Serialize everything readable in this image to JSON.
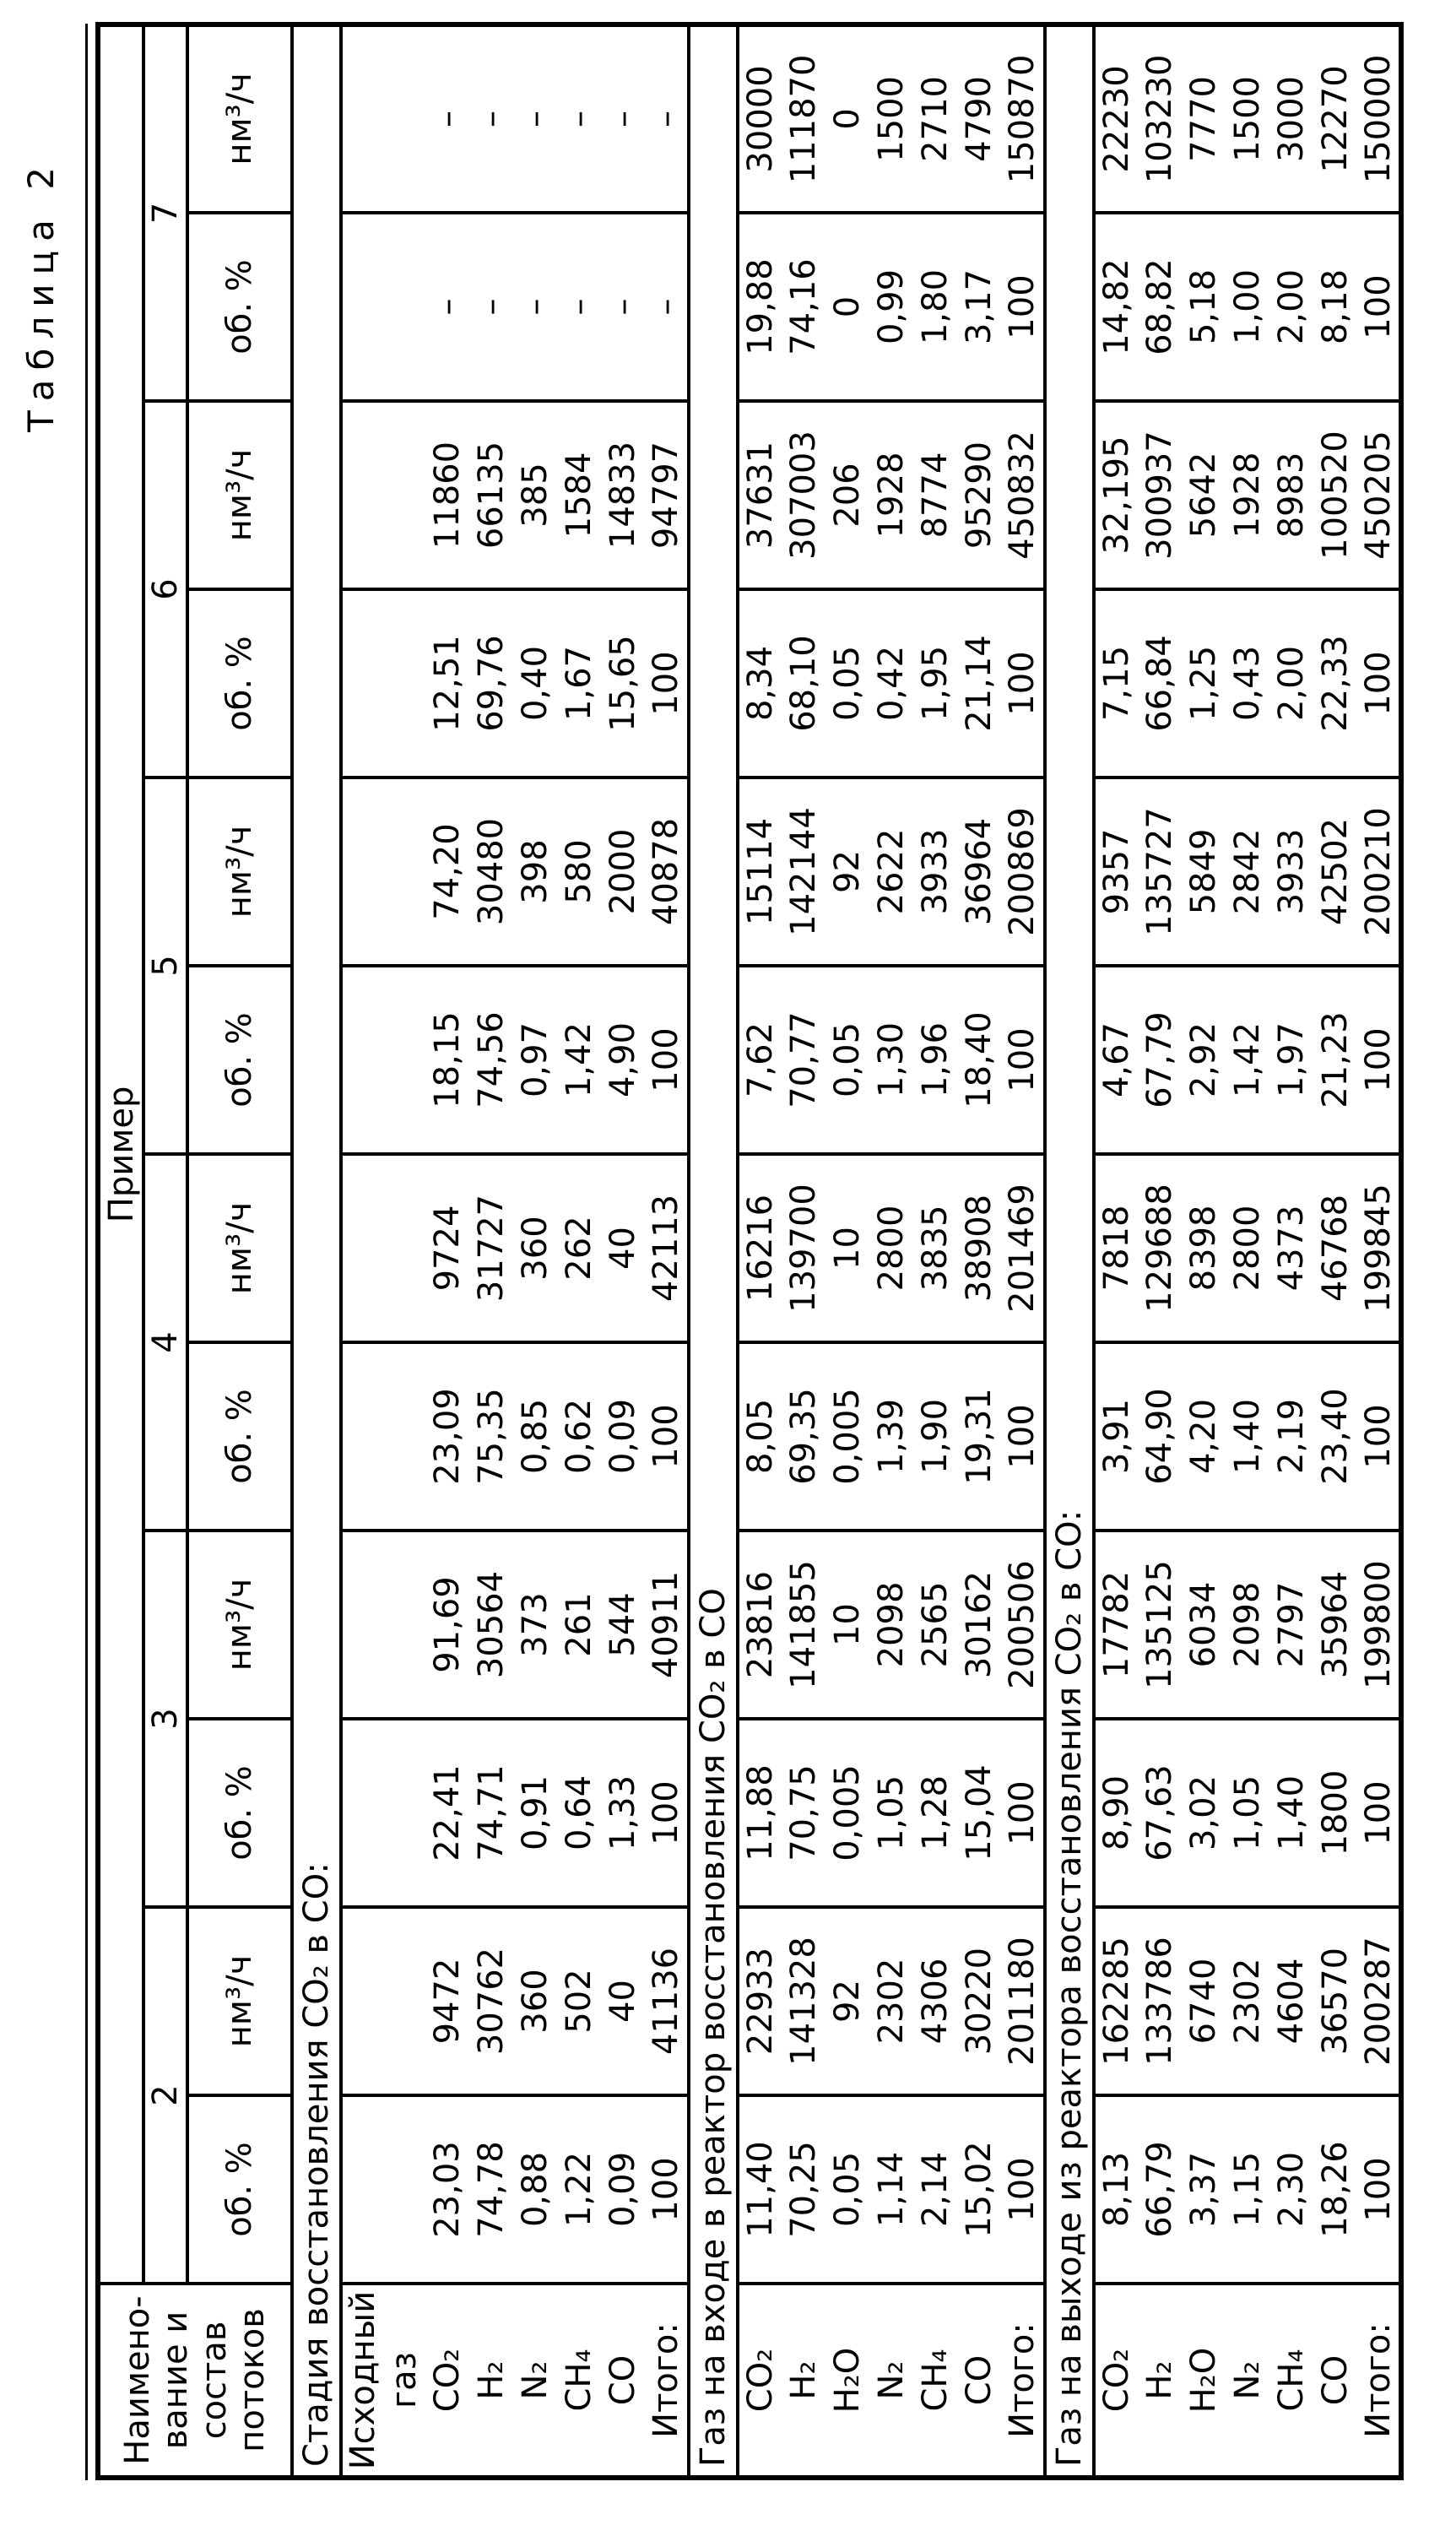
{
  "caption": "Таблица 2",
  "table": {
    "header": {
      "name_lines": [
        "Наимено-",
        "вание и",
        "состав",
        "потоков"
      ],
      "group_title": "Пример",
      "columns": [
        "2",
        "3",
        "4",
        "5",
        "6",
        "7"
      ],
      "units": [
        "об. %",
        "нм³/ч"
      ]
    },
    "sections": [
      {
        "title": "Стадия восстановления CO₂ в CO:",
        "pre_rows": [
          "Исходный",
          "газ"
        ],
        "rows": [
          {
            "label": "CO₂",
            "values": [
              "23,03",
              "9472",
              "22,41",
              "91,69",
              "23,09",
              "9724",
              "18,15",
              "74,20",
              "12,51",
              "11860",
              "–",
              "–"
            ]
          },
          {
            "label": "H₂",
            "values": [
              "74,78",
              "30762",
              "74,71",
              "30564",
              "75,35",
              "31727",
              "74,56",
              "30480",
              "69,76",
              "66135",
              "–",
              "–"
            ]
          },
          {
            "label": "N₂",
            "values": [
              "0,88",
              "360",
              "0,91",
              "373",
              "0,85",
              "360",
              "0,97",
              "398",
              "0,40",
              "385",
              "–",
              "–"
            ]
          },
          {
            "label": "CH₄",
            "values": [
              "1,22",
              "502",
              "0,64",
              "261",
              "0,62",
              "262",
              "1,42",
              "580",
              "1,67",
              "1584",
              "–",
              "–"
            ]
          },
          {
            "label": "CO",
            "values": [
              "0,09",
              "40",
              "1,33",
              "544",
              "0,09",
              "40",
              "4,90",
              "2000",
              "15,65",
              "14833",
              "–",
              "–"
            ]
          },
          {
            "label": "Итого:",
            "values": [
              "100",
              "41136",
              "100",
              "40911",
              "100",
              "42113",
              "100",
              "40878",
              "100",
              "94797",
              "–",
              "–"
            ]
          }
        ]
      },
      {
        "title": "Газ на входе в реактор восстановления CO₂ в CO",
        "pre_rows": [],
        "rows": [
          {
            "label": "CO₂",
            "values": [
              "11,40",
              "22933",
              "11,88",
              "23816",
              "8,05",
              "16216",
              "7,62",
              "15114",
              "8,34",
              "37631",
              "19,88",
              "30000"
            ]
          },
          {
            "label": "H₂",
            "values": [
              "70,25",
              "141328",
              "70,75",
              "141855",
              "69,35",
              "139700",
              "70,77",
              "142144",
              "68,10",
              "307003",
              "74,16",
              "111870"
            ]
          },
          {
            "label": "H₂O",
            "values": [
              "0,05",
              "92",
              "0,005",
              "10",
              "0,005",
              "10",
              "0,05",
              "92",
              "0,05",
              "206",
              "0",
              "0"
            ]
          },
          {
            "label": "N₂",
            "values": [
              "1,14",
              "2302",
              "1,05",
              "2098",
              "1,39",
              "2800",
              "1,30",
              "2622",
              "0,42",
              "1928",
              "0,99",
              "1500"
            ]
          },
          {
            "label": "CH₄",
            "values": [
              "2,14",
              "4306",
              "1,28",
              "2565",
              "1,90",
              "3835",
              "1,96",
              "3933",
              "1,95",
              "8774",
              "1,80",
              "2710"
            ]
          },
          {
            "label": "CO",
            "values": [
              "15,02",
              "30220",
              "15,04",
              "30162",
              "19,31",
              "38908",
              "18,40",
              "36964",
              "21,14",
              "95290",
              "3,17",
              "4790"
            ]
          },
          {
            "label": "Итого:",
            "values": [
              "100",
              "201180",
              "100",
              "200506",
              "100",
              "201469",
              "100",
              "200869",
              "100",
              "450832",
              "100",
              "150870"
            ]
          }
        ]
      },
      {
        "title": "Газ на выходе из реактора восстановления CO₂ в CO:",
        "pre_rows": [],
        "rows": [
          {
            "label": "CO₂",
            "values": [
              "8,13",
              "162285",
              "8,90",
              "17782",
              "3,91",
              "7818",
              "4,67",
              "9357",
              "7,15",
              "32,195",
              "14,82",
              "22230"
            ]
          },
          {
            "label": "H₂",
            "values": [
              "66,79",
              "133786",
              "67,63",
              "135125",
              "64,90",
              "129688",
              "67,79",
              "135727",
              "66,84",
              "300937",
              "68,82",
              "103230"
            ]
          },
          {
            "label": "H₂O",
            "values": [
              "3,37",
              "6740",
              "3,02",
              "6034",
              "4,20",
              "8398",
              "2,92",
              "5849",
              "1,25",
              "5642",
              "5,18",
              "7770"
            ]
          },
          {
            "label": "N₂",
            "values": [
              "1,15",
              "2302",
              "1,05",
              "2098",
              "1,40",
              "2800",
              "1,42",
              "2842",
              "0,43",
              "1928",
              "1,00",
              "1500"
            ]
          },
          {
            "label": "CH₄",
            "values": [
              "2,30",
              "4604",
              "1,40",
              "2797",
              "2,19",
              "4373",
              "1,97",
              "3933",
              "2,00",
              "8983",
              "2,00",
              "3000"
            ]
          },
          {
            "label": "CO",
            "values": [
              "18,26",
              "36570",
              "1800",
              "35964",
              "23,40",
              "46768",
              "21,23",
              "42502",
              "22,33",
              "100520",
              "8,18",
              "12270"
            ]
          },
          {
            "label": "Итого:",
            "values": [
              "100",
              "200287",
              "100",
              "199800",
              "100",
              "199845",
              "100",
              "200210",
              "100",
              "450205",
              "100",
              "150000"
            ]
          }
        ]
      }
    ]
  }
}
